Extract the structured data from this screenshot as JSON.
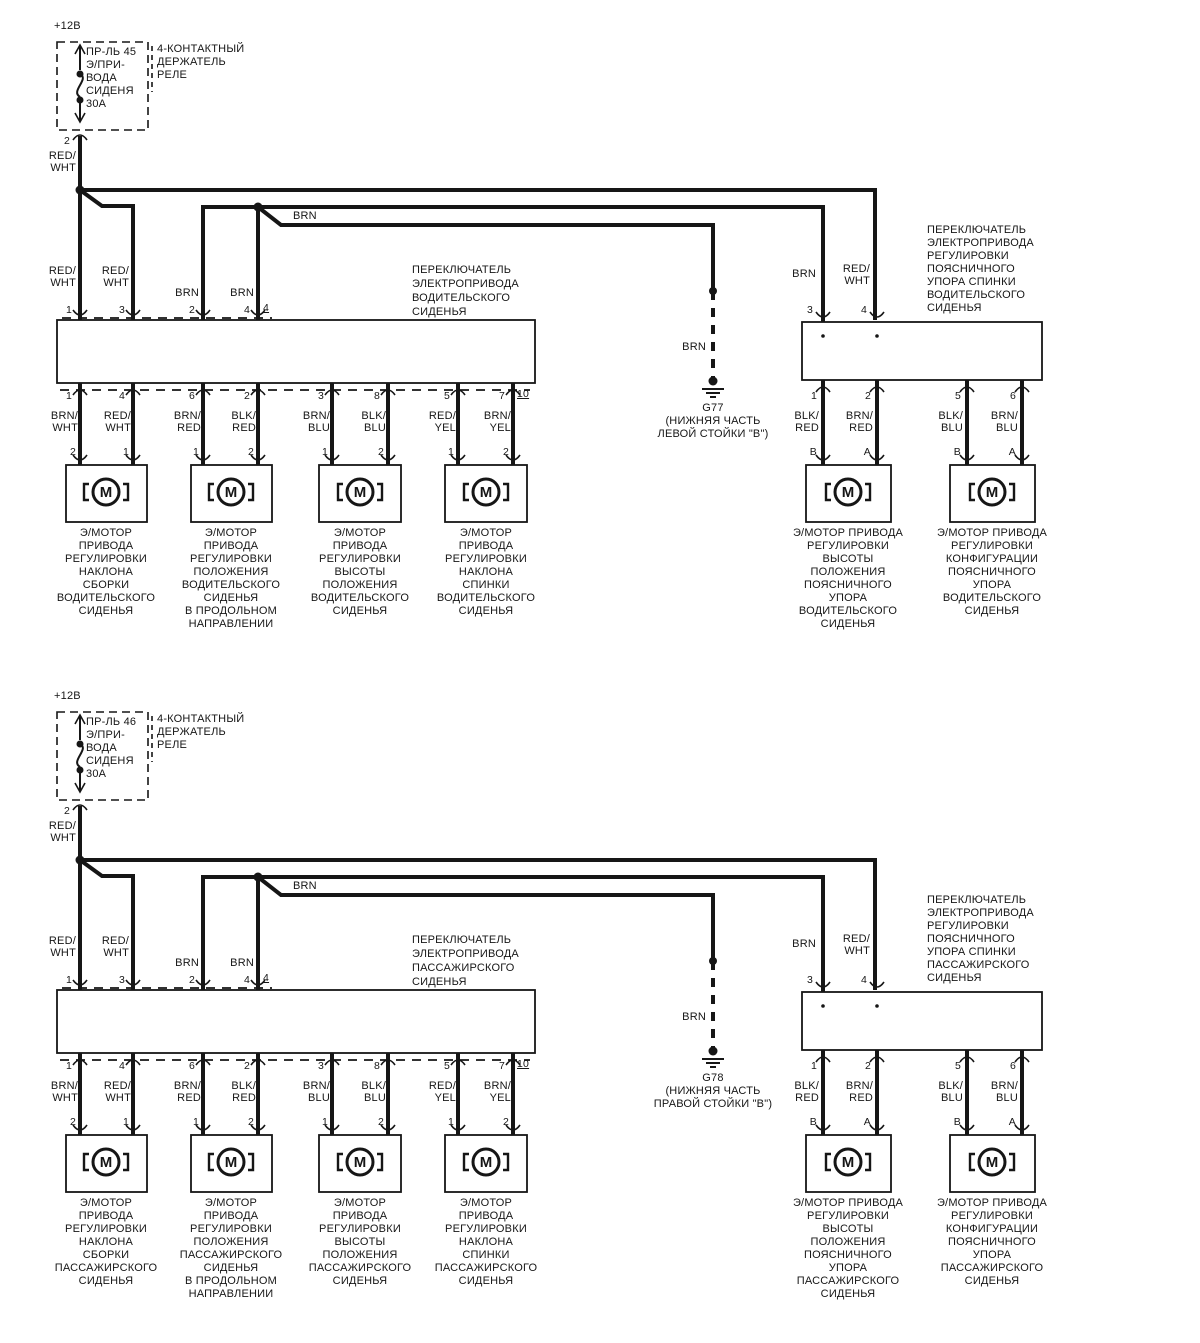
{
  "colors": {
    "ink": "#161616",
    "background": "#ffffff"
  },
  "motor_glyph": "M",
  "halves": [
    {
      "id": "driver-seat-circuit",
      "supply": "+12В",
      "fuse": "ПР-ЛЬ 45\nЭ/ПРИ-\nВОДА\nСИДЕНЯ\n30А",
      "relay": "4-КОНТАКТНЫЙ\nДЕРЖАТЕЛЬ\nРЕЛЕ",
      "fuse_pin": "2",
      "fuse_wire": "RED/\nWHT",
      "rail_label": "BRN",
      "switch": {
        "caption": "ПЕРЕКЛЮЧАТЕЛЬ\nЭЛЕКТРОПРИВОДА\nВОДИТЕЛЬСКОГО\nСИДЕНЬЯ",
        "top_wires": [
          "RED/\nWHT",
          "RED/\nWHT",
          "BRN",
          "BRN"
        ],
        "top_pins": [
          "1",
          "3",
          "2",
          "4"
        ],
        "connector_top": "4",
        "bottom_pins": [
          "1",
          "4",
          "6",
          "2",
          "3",
          "8",
          "5",
          "7"
        ],
        "connector_bottom": "10",
        "bottom_wires": [
          "BRN/\nWHT",
          "RED/\nWHT",
          "BRN/\nRED",
          "BLK/\nRED",
          "BRN/\nBLU",
          "BLK/\nBLU",
          "RED/\nYEL",
          "BRN/\nYEL"
        ],
        "motor_pins": [
          "2",
          "1",
          "1",
          "2",
          "1",
          "2",
          "1",
          "2"
        ]
      },
      "motors": [
        "Э/МОТОР\nПРИВОДА\nРЕГУЛИРОВКИ\nНАКЛОНА\nСБОРКИ\nВОДИТЕЛЬСКОГО\nСИДЕНЬЯ",
        "Э/МОТОР\nПРИВОДА\nРЕГУЛИРОВКИ\nПОЛОЖЕНИЯ\nВОДИТЕЛЬСКОГО\nСИДЕНЬЯ\nВ ПРОДОЛЬНОМ\nНАПРАВЛЕНИИ",
        "Э/МОТОР\nПРИВОДА\nРЕГУЛИРОВКИ\nВЫСОТЫ\nПОЛОЖЕНИЯ\nВОДИТЕЛЬСКОГО\nСИДЕНЬЯ",
        "Э/МОТОР\nПРИВОДА\nРЕГУЛИРОВКИ\nНАКЛОНА\nСПИНКИ\nВОДИТЕЛЬСКОГО\nСИДЕНЬЯ"
      ],
      "ground": {
        "wire": "BRN",
        "label": "G77\n(НИЖНЯЯ ЧАСТЬ\nЛЕВОЙ СТОЙКИ \"В\")"
      },
      "lumbar": {
        "caption": "ПЕРЕКЛЮЧАТЕЛЬ\nЭЛЕКТРОПРИВОДА\nРЕГУЛИРОВКИ\nПОЯСНИЧНОГО\nУПОРА СПИНКИ\nВОДИТЕЛЬСКОГО\nСИДЕНЬЯ",
        "top_wires": [
          "BRN",
          "RED/\nWHT"
        ],
        "top_pins": [
          "3",
          "4"
        ],
        "bottom_pins": [
          "1",
          "2",
          "5",
          "6"
        ],
        "bottom_wires": [
          "BLK/\nRED",
          "BRN/\nRED",
          "BLK/\nBLU",
          "BRN/\nBLU"
        ],
        "terminals": [
          "B",
          "A",
          "B",
          "A"
        ],
        "motors": [
          "Э/МОТОР ПРИВОДА\nРЕГУЛИРОВКИ\nВЫСОТЫ\nПОЛОЖЕНИЯ\nПОЯСНИЧНОГО\nУПОРА\nВОДИТЕЛЬСКОГО\nСИДЕНЬЯ",
          "Э/МОТОР ПРИВОДА\nРЕГУЛИРОВКИ\nКОНФИГУРАЦИИ\nПОЯСНИЧНОГО\nУПОРА\nВОДИТЕЛЬСКОГО\nСИДЕНЬЯ"
        ]
      }
    },
    {
      "id": "passenger-seat-circuit",
      "supply": "+12В",
      "fuse": "ПР-ЛЬ 46\nЭ/ПРИ-\nВОДА\nСИДЕНЯ\n30А",
      "relay": "4-КОНТАКТНЫЙ\nДЕРЖАТЕЛЬ\nРЕЛЕ",
      "fuse_pin": "2",
      "fuse_wire": "RED/\nWHT",
      "rail_label": "BRN",
      "switch": {
        "caption": "ПЕРЕКЛЮЧАТЕЛЬ\nЭЛЕКТРОПРИВОДА\nПАССАЖИРСКОГО\nСИДЕНЬЯ",
        "top_wires": [
          "RED/\nWHT",
          "RED/\nWHT",
          "BRN",
          "BRN"
        ],
        "top_pins": [
          "1",
          "3",
          "2",
          "4"
        ],
        "connector_top": "4",
        "bottom_pins": [
          "1",
          "4",
          "6",
          "2",
          "3",
          "8",
          "5",
          "7"
        ],
        "connector_bottom": "10",
        "bottom_wires": [
          "BRN/\nWHT",
          "RED/\nWHT",
          "BRN/\nRED",
          "BLK/\nRED",
          "BRN/\nBLU",
          "BLK/\nBLU",
          "RED/\nYEL",
          "BRN/\nYEL"
        ],
        "motor_pins": [
          "2",
          "1",
          "1",
          "2",
          "1",
          "2",
          "1",
          "2"
        ]
      },
      "motors": [
        "Э/МОТОР\nПРИВОДА\nРЕГУЛИРОВКИ\nНАКЛОНА\nСБОРКИ\nПАССАЖИРСКОГО\nСИДЕНЬЯ",
        "Э/МОТОР\nПРИВОДА\nРЕГУЛИРОВКИ\nПОЛОЖЕНИЯ\nПАССАЖИРСКОГО\nСИДЕНЬЯ\nВ ПРОДОЛЬНОМ\nНАПРАВЛЕНИИ",
        "Э/МОТОР\nПРИВОДА\nРЕГУЛИРОВКИ\nВЫСОТЫ\nПОЛОЖЕНИЯ\nПАССАЖИРСКОГО\nСИДЕНЬЯ",
        "Э/МОТОР\nПРИВОДА\nРЕГУЛИРОВКИ\nНАКЛОНА\nСПИНКИ\nПАССАЖИРСКОГО\nСИДЕНЬЯ"
      ],
      "ground": {
        "wire": "BRN",
        "label": "G78\n(НИЖНЯЯ ЧАСТЬ\nПРАВОЙ СТОЙКИ \"В\")"
      },
      "lumbar": {
        "caption": "ПЕРЕКЛЮЧАТЕЛЬ\nЭЛЕКТРОПРИВОДА\nРЕГУЛИРОВКИ\nПОЯСНИЧНОГО\nУПОРА СПИНКИ\nПАССАЖИРСКОГО\nСИДЕНЬЯ",
        "top_wires": [
          "BRN",
          "RED/\nWHT"
        ],
        "top_pins": [
          "3",
          "4"
        ],
        "bottom_pins": [
          "1",
          "2",
          "5",
          "6"
        ],
        "bottom_wires": [
          "BLK/\nRED",
          "BRN/\nRED",
          "BLK/\nBLU",
          "BRN/\nBLU"
        ],
        "terminals": [
          "B",
          "A",
          "B",
          "A"
        ],
        "motors": [
          "Э/МОТОР ПРИВОДА\nРЕГУЛИРОВКИ\nВЫСОТЫ\nПОЛОЖЕНИЯ\nПОЯСНИЧНОГО\nУПОРА\nПАССАЖИРСКОГО\nСИДЕНЬЯ",
          "Э/МОТОР ПРИВОДА\nРЕГУЛИРОВКИ\nКОНФИГУРАЦИИ\nПОЯСНИЧНОГО\nУПОРА\nПАССАЖИРСКОГО\nСИДЕНЬЯ"
        ]
      }
    }
  ]
}
